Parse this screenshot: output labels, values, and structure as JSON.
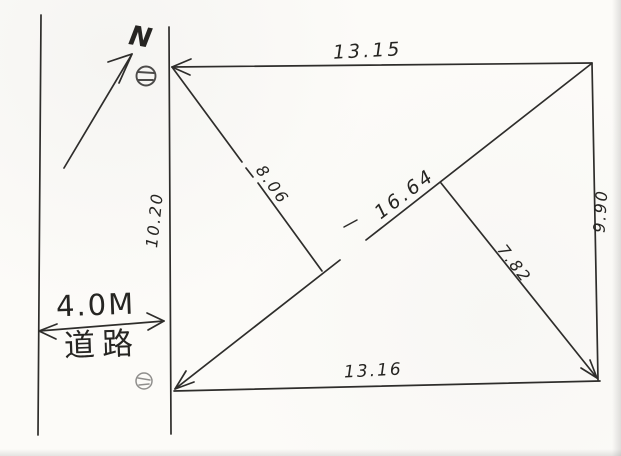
{
  "sketch": {
    "north_label": "N",
    "parcel": {
      "top_length": "13.15",
      "bottom_length": "13.16",
      "left_length": "10.20",
      "right_length": "9.90",
      "diagonal_length": "16.64",
      "upper_offset_length": "8.06",
      "lower_offset_length": "7.82"
    },
    "road": {
      "width_label": "4.0M",
      "name_label": "道路"
    },
    "colors": {
      "ink": "#2e2d2b",
      "paper": "#fcfbf8"
    },
    "icons": {
      "north_arrow": "north-arrow-icon",
      "marker_top": "boundary-marker-icon",
      "marker_bottom": "boundary-marker-icon"
    }
  }
}
